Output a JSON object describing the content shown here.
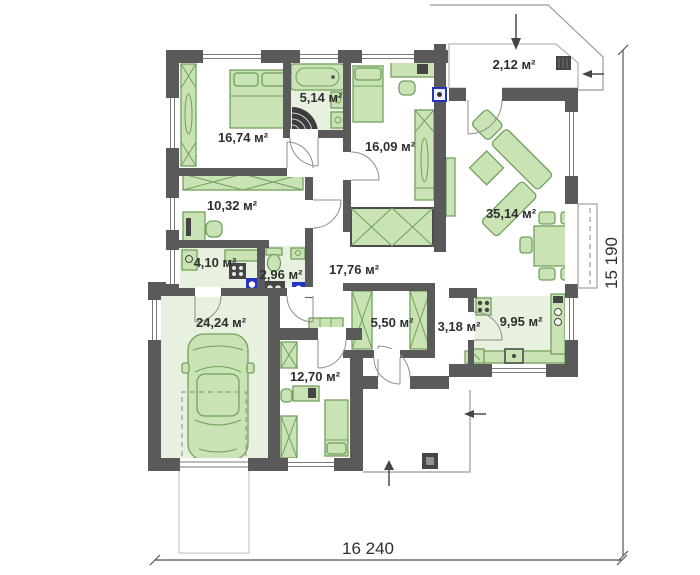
{
  "plan": {
    "kind": "floor-plan"
  },
  "rooms": [
    {
      "id": "bedroom-1",
      "area_label": "16,74 м²"
    },
    {
      "id": "bathroom",
      "area_label": "5,14 м²"
    },
    {
      "id": "bedroom-2",
      "area_label": "16,09 м²"
    },
    {
      "id": "porch",
      "area_label": "2,12 м²"
    },
    {
      "id": "living-room",
      "area_label": "35,14 м²"
    },
    {
      "id": "hall",
      "area_label": "10,32 м²"
    },
    {
      "id": "utility",
      "area_label": "4,10 м²"
    },
    {
      "id": "wc",
      "area_label": "2,96 м²"
    },
    {
      "id": "corridor",
      "area_label": "17,76 м²"
    },
    {
      "id": "garage",
      "area_label": "24,24 м²"
    },
    {
      "id": "closet",
      "area_label": "5,50 м²"
    },
    {
      "id": "entry-hall",
      "area_label": "3,18 м²"
    },
    {
      "id": "kitchen",
      "area_label": "9,95 м²"
    },
    {
      "id": "bedroom-3",
      "area_label": "12,70 м²"
    }
  ],
  "dimensions": {
    "width_label": "16 240",
    "height_label": "15 190"
  },
  "colors": {
    "wall": "#5a5a5a",
    "furniture_fill": "#c9e3b4",
    "furniture_stroke": "#72a05c",
    "floor_tint": "#e8f1e0",
    "accent_blue": "#2433c0",
    "dark_fixture": "#454545"
  }
}
